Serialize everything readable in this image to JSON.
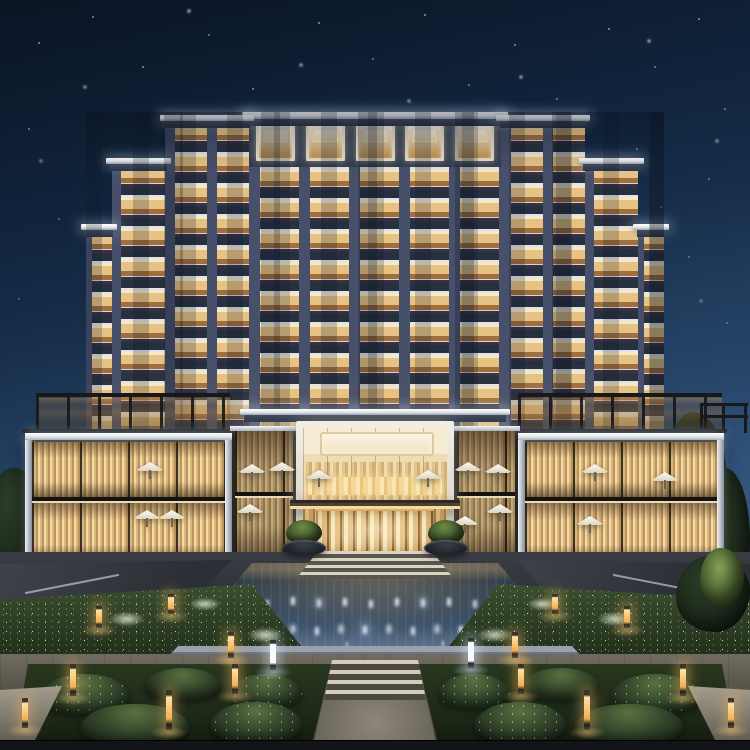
{
  "meta": {
    "title": "Luxury hotel exterior at night",
    "description": "Photorealistic rendering of a symmetrical modern luxury hotel at night: an illuminated ten-storey stepped tower with warm-lit balconies and white LED cornice strips rises above two glass dining pavilions and a central double-height entrance atrium; in front lie a reflecting pool with rows of fountain jets, flower beds, clipped hedge parterres, amber bollard lights, stone paths and curved driveways under a starry deep-blue sky."
  },
  "scene": {
    "sky": {
      "time": "night",
      "stars": true,
      "gradient_top": "#0a1424",
      "gradient_bottom": "#4e739b"
    },
    "building": {
      "kind": "hotel tower",
      "storeys_visible": 10,
      "center_bays": 5,
      "sections": [
        "far-left wing",
        "left step wing",
        "left flank tower",
        "central block",
        "right flank tower",
        "right step wing",
        "far-right wing"
      ],
      "lighting": [
        "warm room lighting",
        "white LED cornice strips",
        "lit balcony railings"
      ]
    },
    "podium": {
      "left_pavilion": "two-storey glass restaurant pavilion with sheer curtains, patio umbrellas and rooftop pergola terrace",
      "right_pavilion": "two-storey glass restaurant pavilion with sheer curtains, patio umbrellas and rooftop pergola terrace",
      "entrance": "double-height glass entrance atrium with cream ceiling cove, sheer curtains, buffet lighting, dark canopy and gold-framed doors",
      "umbrella_count": 15
    },
    "grounds": {
      "water_feature": "reflecting pool with two rows of illuminated fountain jets",
      "gardens": [
        "upper flower beds with white blooms",
        "lower clipped hedge parterre"
      ],
      "lights": {
        "amber_bollards": 14,
        "white_bollards": 2
      },
      "paths": "stone steps and walkways",
      "roads": "curved driveways with white lane markings on both sides"
    },
    "vegetation": {
      "trees_right": 4,
      "trees_left": 1,
      "lit_tree": 1
    }
  },
  "palette": {
    "sky_top": "#0a1424",
    "sky_horizon": "#4e739b",
    "facade": "#2e3949",
    "window_warm": "#e6c385",
    "window_deep": "#a06f3c",
    "cornice": "#f0f3f6",
    "curtain": "#d9b87c",
    "canopy": "#46382a",
    "pool": "#3c5168",
    "garden": "#31432a",
    "bollard_amber": "#f6bf66",
    "stone": "#c9c2b2",
    "asphalt": "#33373d",
    "gold": "#caa05a"
  },
  "css_vars": "--sky1:#0a1424;--sky2:#142a45;--sky3:#2e4f76;--sky4:#4e739b;--facade:#2e3949;--pier:#46506a;--slab:#27303f;--win-hi:#f6e8c4;--win-mid:#e6c385;--win-lo:#a06f3c;--cornice:#f0f3f6;--rail:#cfd8e0;--curt1:#f2dcae;--curt2:#d9b87c;--curt3:#c09257;--canopy:#46382a;--pool1:#16202c;--pool2:#3c5168;--pool3:#5d7590;--green-d:#1e2a1a;--green-m:#31432a;--green-h:#5a7040;--stone:#c9c2b2;--stone-d:#55524a;--amber:#f6bf66;--cool:#eef4f9;--asphalt:#33373d;--gold:#caa05a"
}
